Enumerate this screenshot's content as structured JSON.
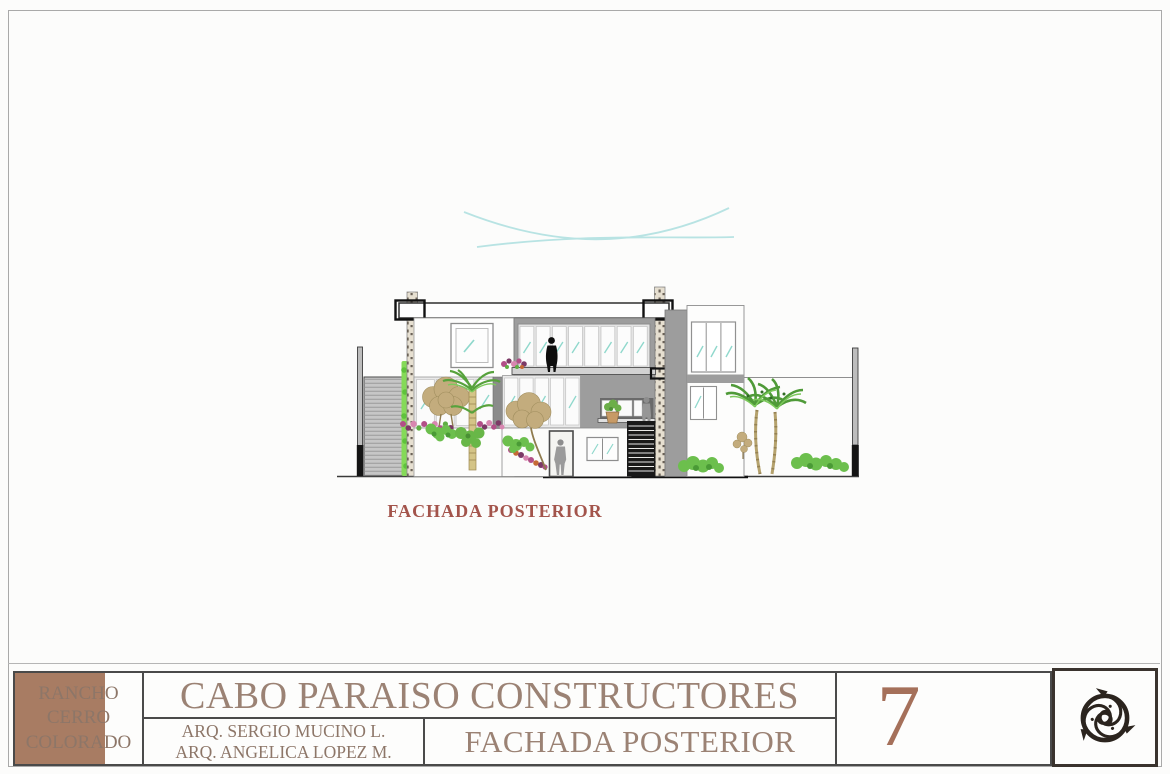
{
  "sheet": {
    "drawing": {
      "caption": "FACHADA POSTERIOR"
    },
    "title_block": {
      "project_lines": [
        "RANCHO",
        "CERRO",
        "COLORADO"
      ],
      "company": "CABO PARAISO CONSTRUCTORES",
      "architects": [
        "ARQ. SERGIO MUCINO L.",
        "ARQ. ANGELICA LOPEZ M."
      ],
      "sheet_title": "FACHADA POSTERIOR",
      "sheet_number": "7"
    },
    "logo": {
      "icon": "fish-triskelion-logo"
    },
    "colors": {
      "brand_text": "#9B8274",
      "secondary_text": "#8D7668",
      "sheet_number_text": "#A5705A",
      "caption_text": "#A3544B",
      "accent_block": "#A87C63",
      "wall_gray": "#9C9C9C",
      "glass_teal": "#8FD8CC",
      "sky_line_teal": "#A8DEDE",
      "vegetation_green": "#6CBF4D",
      "tree_tan": "#C3AC7D",
      "flower_magenta": "#B24F88",
      "stair_dark": "#191919"
    }
  }
}
